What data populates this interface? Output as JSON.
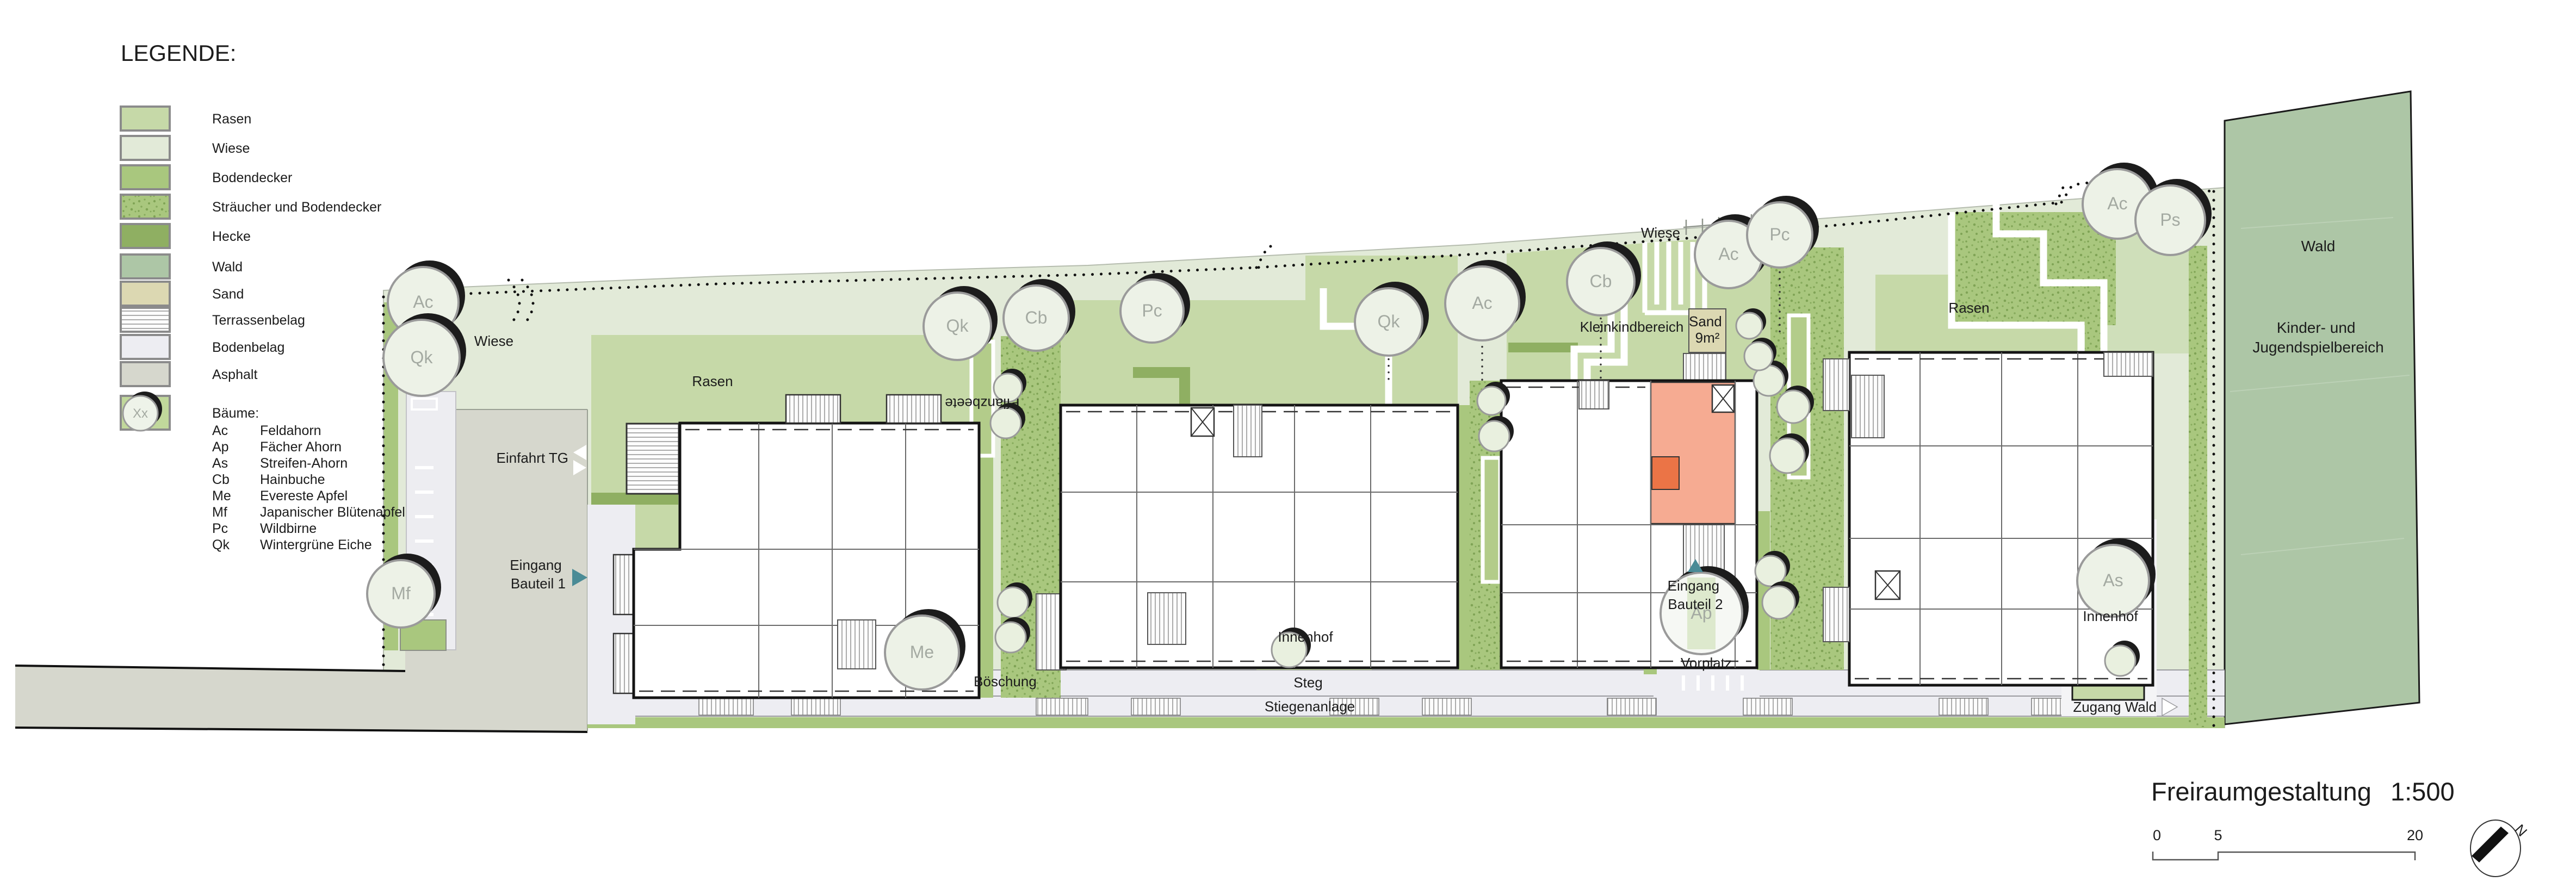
{
  "legend": {
    "title": "LEGENDE:",
    "items": [
      {
        "label": "Rasen",
        "color": "#c6d9a8",
        "pattern": "solid"
      },
      {
        "label": "Wiese",
        "color": "#e2ead8",
        "pattern": "solid"
      },
      {
        "label": "Bodendecker",
        "color": "#a9c77e",
        "pattern": "solid"
      },
      {
        "label": "Sträucher und Bodendecker",
        "color": "#a9c77e",
        "pattern": "speckle"
      },
      {
        "label": "Hecke",
        "color": "#8faf62",
        "pattern": "solid"
      },
      {
        "label": "Wald",
        "color": "#adc6a6",
        "pattern": "solid"
      },
      {
        "label": "Sand",
        "color": "#dcd8b2",
        "pattern": "solid"
      },
      {
        "label": "Terrassenbelag",
        "color": "#ffffff",
        "pattern": "hstripe"
      },
      {
        "label": "Bodenbelag",
        "color": "#ededf2",
        "pattern": "solid"
      },
      {
        "label": "Asphalt",
        "color": "#d6d7cd",
        "pattern": "solid"
      }
    ],
    "trees_title": "Bäume:",
    "tree_symbol_code": "Xx",
    "species": [
      {
        "code": "Ac",
        "name": "Feldahorn"
      },
      {
        "code": "Ap",
        "name": "Fächer Ahorn"
      },
      {
        "code": "As",
        "name": "Streifen-Ahorn"
      },
      {
        "code": "Cb",
        "name": "Hainbuche"
      },
      {
        "code": "Me",
        "name": "Evereste Apfel"
      },
      {
        "code": "Mf",
        "name": "Japanischer Blütenapfel"
      },
      {
        "code": "Pc",
        "name": "Wildbirne"
      },
      {
        "code": "Qk",
        "name": "Wintergrüne Eiche"
      }
    ]
  },
  "plan": {
    "labels": {
      "wiese_left": "Wiese",
      "wiese_top": "Wiese",
      "rasen_left": "Rasen",
      "rasen_right": "Rasen",
      "einfahrt_tg": "Einfahrt TG",
      "eingang_bt1": [
        "Eingang",
        "Bauteil 1"
      ],
      "eingang_bt2": [
        "Eingang",
        "Bauteil 2"
      ],
      "pflanzbeete": "Pflanzbeete",
      "boeschung": "Böschung",
      "innenhof_left": "Innenhof",
      "innenhof_right": "Innenhof",
      "steg": "Steg",
      "stiegenanlage": "Stiegenanlage",
      "kleinkindbereich": "Kleinkindbereich",
      "sand": [
        "Sand",
        "9m²"
      ],
      "vorplatz": "Vorplatz",
      "zugang_wald": "Zugang Wald",
      "wald": "Wald",
      "kinderspiel": [
        "Kinder- und",
        "Jugendspielbereich"
      ]
    },
    "trees": [
      {
        "code": "Ac"
      },
      {
        "code": "Qk"
      },
      {
        "code": "Mf"
      },
      {
        "code": "Qk"
      },
      {
        "code": "Cb"
      },
      {
        "code": "Pc"
      },
      {
        "code": "Me"
      },
      {
        "code": "Qk"
      },
      {
        "code": "Ac"
      },
      {
        "code": "Cb"
      },
      {
        "code": "Ac"
      },
      {
        "code": "Pc"
      },
      {
        "code": "Ap"
      },
      {
        "code": "Ac"
      },
      {
        "code": "Ps"
      },
      {
        "code": "As"
      }
    ],
    "colors": {
      "rasen": "#c6d9a8",
      "wiese": "#e2ead8",
      "bodendecker": "#a9c77e",
      "hecke": "#8faf62",
      "wald": "#adc6a6",
      "sand": "#dcd8b2",
      "bodenbelag": "#ededf2",
      "asphalt": "#d6d7cd",
      "highlight_unit": "#f6ab92",
      "highlight_unit_dark": "#eb7446",
      "arrow_teal": "#4a8b96"
    }
  },
  "title_block": {
    "title": "Freiraumgestaltung",
    "scale": "1:500",
    "scalebar_ticks": [
      "0",
      "5",
      "20"
    ],
    "north_letter": "N"
  }
}
